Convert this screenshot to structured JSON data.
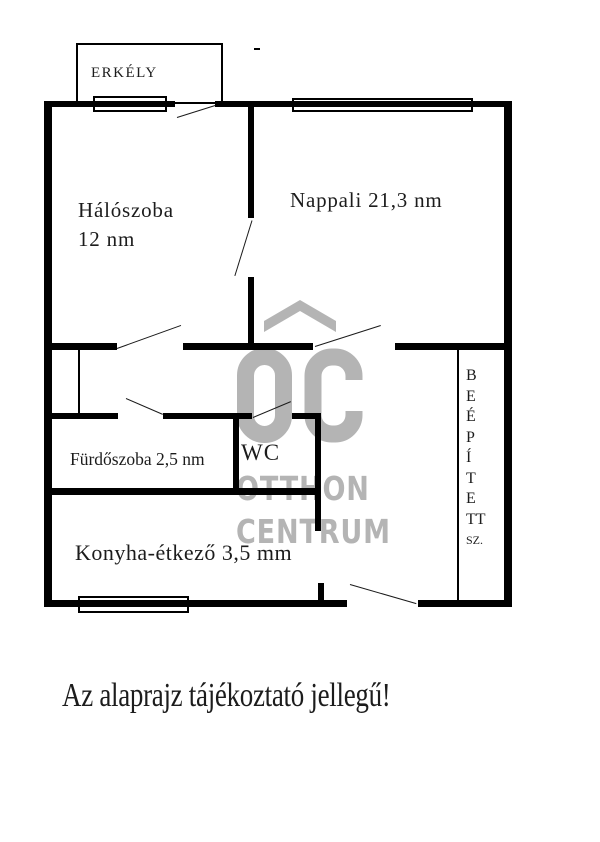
{
  "floorplan": {
    "title_note": "",
    "rooms": [
      {
        "id": "erkely",
        "label": "ERKÉLY"
      },
      {
        "id": "haloszoba",
        "label": "Hálószoba",
        "area": "12 nm"
      },
      {
        "id": "nappali",
        "label": "Nappali 21,3 nm"
      },
      {
        "id": "furdoszoba",
        "label": "Fürdőszoba 2,5 nm"
      },
      {
        "id": "wc",
        "label": "WC"
      },
      {
        "id": "konyha",
        "label": "Konyha-étkező 3,5 mm"
      },
      {
        "id": "beepitett",
        "label": "BEÉPÍTETT SZ.",
        "letters": [
          "B",
          "E",
          "É",
          "P",
          "Í",
          "T",
          "E",
          "TT",
          "SZ."
        ]
      }
    ],
    "watermark": {
      "mark": "OC",
      "line1": "OTTHON",
      "line2": "CENTRUM",
      "color": "#b4b4b4"
    },
    "disclaimer": "Az alaprajz tájékoztató jellegű!",
    "colors": {
      "wall": "#000000",
      "line": "#1a1a1a",
      "watermark": "#b4b4b4",
      "background": "#ffffff",
      "text": "#1c1c1c"
    }
  }
}
